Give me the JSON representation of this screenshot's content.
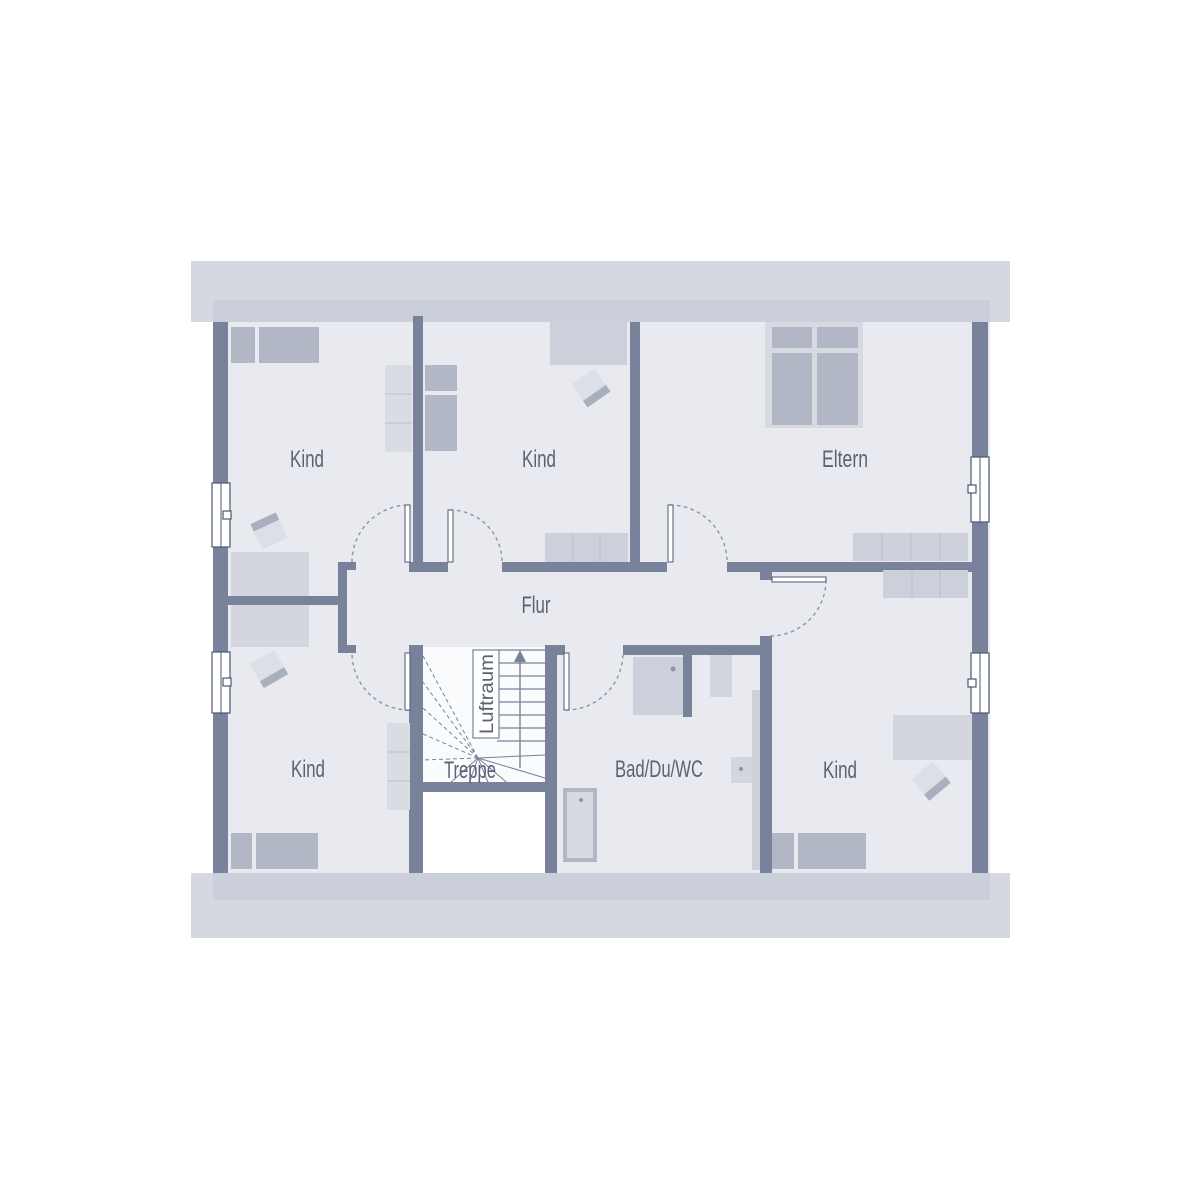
{
  "palette": {
    "bg": "#ffffff",
    "band_outer": "#d6d8e1",
    "band_inner": "#cbcfda",
    "room": "#e8eaf0",
    "wall": "#78829a",
    "furn_med": "#b1b7c4",
    "furn_light": "#d3d6df",
    "furn_mid2": "#ccd0da",
    "shelf": "#d9dce3",
    "bed_base": "#d7dae1",
    "chair": "#dcdfe6",
    "chair_edge": "#a9b0bd",
    "stairs_bg": "#fafbfd",
    "void": "#ffffff",
    "line": "#77819a",
    "frame": "#4d5870",
    "arc": "#8b93a3",
    "dot": "#8d95a5",
    "label": "#5a6273"
  },
  "rooms": {
    "kind_top_left": {
      "label": "Kind"
    },
    "kind_top_middle": {
      "label": "Kind"
    },
    "eltern": {
      "label": "Eltern"
    },
    "flur": {
      "label": "Flur"
    },
    "treppe": {
      "label": "Treppe"
    },
    "bad": {
      "label": "Bad/Du/WC"
    },
    "kind_bottom_left": {
      "label": "Kind"
    },
    "kind_bottom_right": {
      "label": "Kind"
    },
    "luftraum": {
      "label": "Luftraum"
    }
  }
}
